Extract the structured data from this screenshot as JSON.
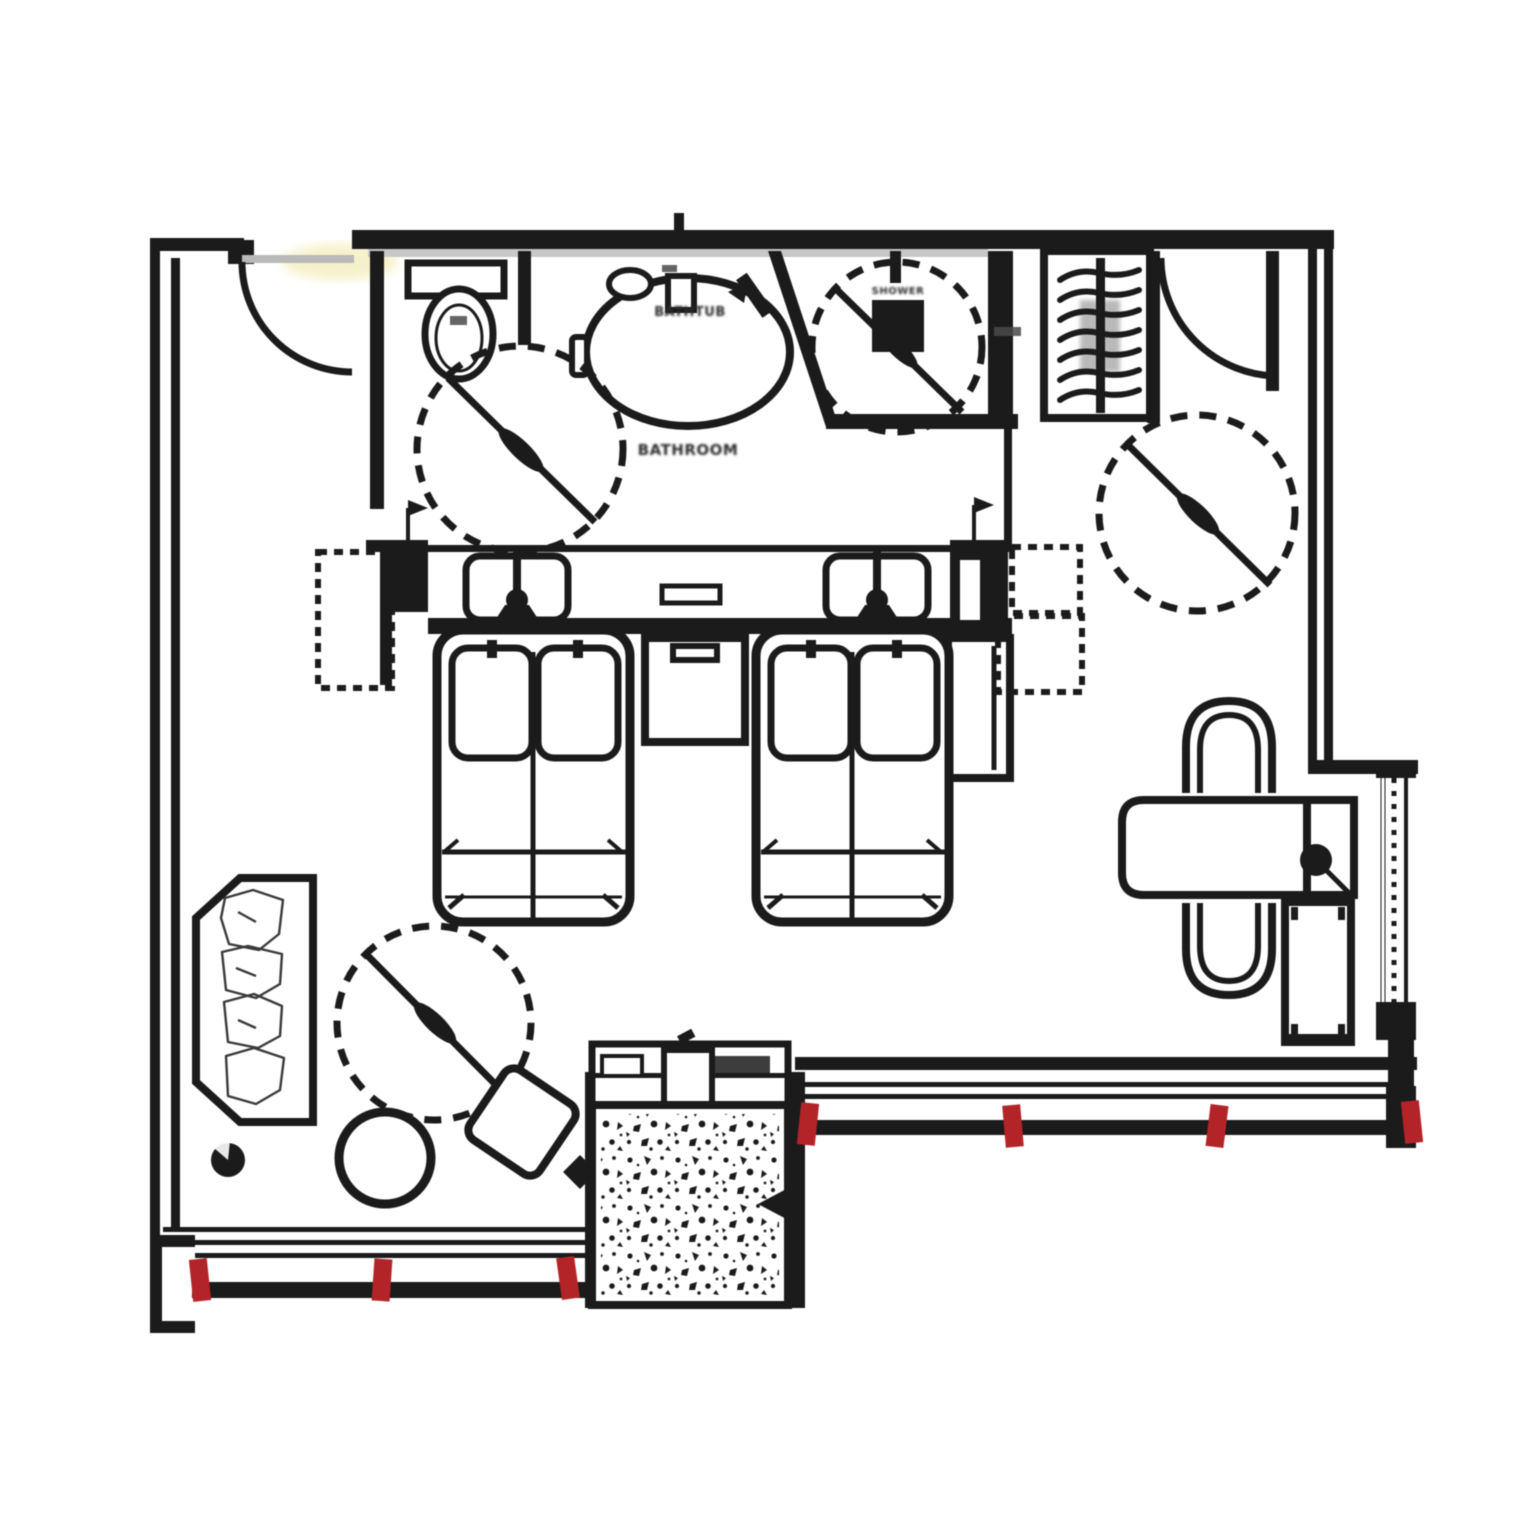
{
  "plan": {
    "labels": {
      "bathtub": "BATHTUB",
      "bathroom": "BATHROOM",
      "shower": "SHOWER"
    },
    "colors": {
      "ink": "#1b1b1b",
      "red": "#b32429",
      "door_leaf": "#b9b9b9",
      "wall_shadow": "#c8c8c8",
      "glow": "#efe8a8",
      "paper": "#ffffff"
    },
    "window_markers": [
      {
        "x": 200,
        "y": 1280,
        "rot": -6
      },
      {
        "x": 382,
        "y": 1280,
        "rot": 4
      },
      {
        "x": 568,
        "y": 1278,
        "rot": -8
      },
      {
        "x": 808,
        "y": 1124,
        "rot": 6
      },
      {
        "x": 1013,
        "y": 1126,
        "rot": -5
      },
      {
        "x": 1217,
        "y": 1126,
        "rot": 7
      },
      {
        "x": 1412,
        "y": 1122,
        "rot": -6
      }
    ]
  }
}
